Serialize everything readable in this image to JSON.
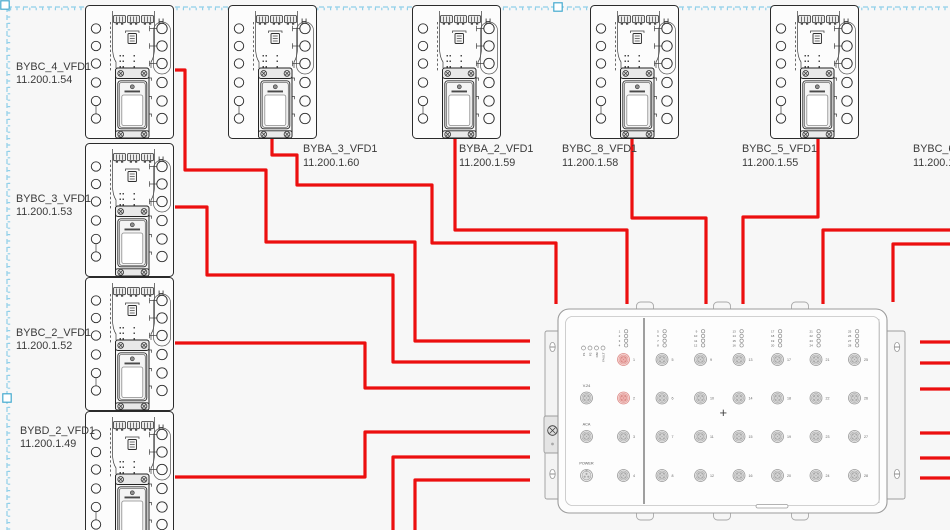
{
  "style": {
    "background": "#f7f7f7",
    "wire_color": "#ec0f0f",
    "wire_width": 3.2,
    "selection_color": "#8fcfe9",
    "selection_handle_border": "#45aacf",
    "device_outline": "#2b2b2b",
    "switch_outline": "#9c9c9c",
    "label_color": "#3b3b3b"
  },
  "vfd_symbol": {
    "corner_mark": "H"
  },
  "devices": [
    {
      "name": "BYBC_4_VFD1",
      "ip": "11.200.1.54",
      "x": 85,
      "y": 5,
      "label": {
        "x": 16,
        "y1": 70,
        "y2": 83
      }
    },
    {
      "name": "BYBC_3_VFD1",
      "ip": "11.200.1.53",
      "x": 85,
      "y": 143,
      "label": {
        "x": 16,
        "y1": 202,
        "y2": 215
      }
    },
    {
      "name": "BYBC_2_VFD1",
      "ip": "11.200.1.52",
      "x": 85,
      "y": 277,
      "label": {
        "x": 16,
        "y1": 336,
        "y2": 349
      }
    },
    {
      "name": "BYBD_2_VFD1",
      "ip": "11.200.1.49",
      "x": 85,
      "y": 411,
      "label": {
        "x": 20,
        "y1": 434,
        "y2": 447
      }
    },
    {
      "name": "BYBA_3_VFD1",
      "ip": "11.200.1.60",
      "x": 228,
      "y": 5,
      "label": {
        "x": 303,
        "y1": 152,
        "y2": 166
      }
    },
    {
      "name": "BYBA_2_VFD1",
      "ip": "11.200.1.59",
      "x": 412,
      "y": 5,
      "label": {
        "x": 459,
        "y1": 152,
        "y2": 166
      }
    },
    {
      "name": "BYBC_8_VFD1",
      "ip": "11.200.1.58",
      "x": 590,
      "y": 5,
      "label": {
        "x": 562,
        "y1": 152,
        "y2": 166
      }
    },
    {
      "name": "BYBC_5_VFD1",
      "ip": "11.200.1.55",
      "x": 770,
      "y": 5,
      "label": {
        "x": 742,
        "y1": 152,
        "y2": 166
      }
    }
  ],
  "offcanvas_device": {
    "name": "BYBC_6_",
    "ip": "11.200.1",
    "label": {
      "x": 913,
      "y1": 152,
      "y2": 166
    }
  },
  "switch_unit": {
    "center_mark": "+",
    "status_leds": [
      "P1",
      "P2",
      "RM",
      "FAULT"
    ],
    "status_led_x": 583.5,
    "status_led_y": 348,
    "aux_x": 586.5,
    "aux_ports": [
      {
        "label": "V.24",
        "y": 398
      },
      {
        "label": "ACA",
        "y": 436.5
      },
      {
        "label": "POWER",
        "y": 475.5
      }
    ],
    "cluster_row_ys": [
      331.3,
      336,
      340.7,
      345.4
    ],
    "row_ys": [
      359.5,
      398,
      436.5,
      475.5
    ],
    "port_columns": [
      {
        "x": 623.5,
        "ports": [
          1,
          2,
          3,
          4
        ]
      },
      {
        "x": 662,
        "ports": [
          5,
          6,
          7,
          8
        ]
      },
      {
        "x": 700.5,
        "ports": [
          9,
          10,
          11,
          12
        ]
      },
      {
        "x": 739,
        "ports": [
          13,
          14,
          15,
          16
        ]
      },
      {
        "x": 777.5,
        "ports": [
          17,
          18,
          19,
          20
        ]
      },
      {
        "x": 816,
        "ports": [
          21,
          22,
          23,
          24
        ]
      },
      {
        "x": 854.5,
        "ports": [
          25,
          26,
          27,
          28
        ]
      }
    ],
    "highlighted_ports": [
      1,
      2
    ]
  },
  "wires": [
    {
      "id": "bybc4-to-switch",
      "points": "175,70 185,70 185,170 266,170 266,242 415,242 415,341 530,341"
    },
    {
      "id": "bybc3-to-switch",
      "points": "175,207 207,207 207,275 393,275 393,362 530,362"
    },
    {
      "id": "bybc2-to-switch",
      "points": "175,343 365,343 365,388 530,388"
    },
    {
      "id": "bybd2-to-switch",
      "points": "175,477 365,477 365,432 530,432"
    },
    {
      "id": "bottom-riser-1",
      "points": "393,531 393,457 530,457"
    },
    {
      "id": "bottom-riser-2",
      "points": "415,531 415,480 530,480"
    },
    {
      "id": "byba3-to-switch",
      "points": "272,139 272,155 297,155 297,185 432,185 432,243 556,243 556,304"
    },
    {
      "id": "byba2-to-switch",
      "points": "455,139 455,230 627,230 627,304"
    },
    {
      "id": "bybc8-to-switch",
      "points": "632,139 632,218 706,218 706,304"
    },
    {
      "id": "bybc5-to-switch",
      "points": "818,139 818,217 743,217 743,304"
    },
    {
      "id": "right-edge-in-1",
      "points": "951,230 823,230 823,304"
    },
    {
      "id": "right-edge-in-2",
      "points": "951,244 893,244 893,302"
    },
    {
      "id": "right-stub-1",
      "points": "920,342 951,342"
    },
    {
      "id": "right-stub-2",
      "points": "920,363 951,363"
    },
    {
      "id": "right-stub-3",
      "points": "920,389 951,389"
    },
    {
      "id": "right-stub-4",
      "points": "920,433 951,433"
    },
    {
      "id": "right-stub-5",
      "points": "920,458 951,458"
    },
    {
      "id": "right-stub-6",
      "points": "920,478 951,478"
    }
  ],
  "selection": {
    "top_y": 7,
    "left_x": 7,
    "handles": [
      {
        "x": 5,
        "y": 5
      },
      {
        "x": 558,
        "y": 7
      },
      {
        "x": 7,
        "y": 398
      }
    ]
  }
}
